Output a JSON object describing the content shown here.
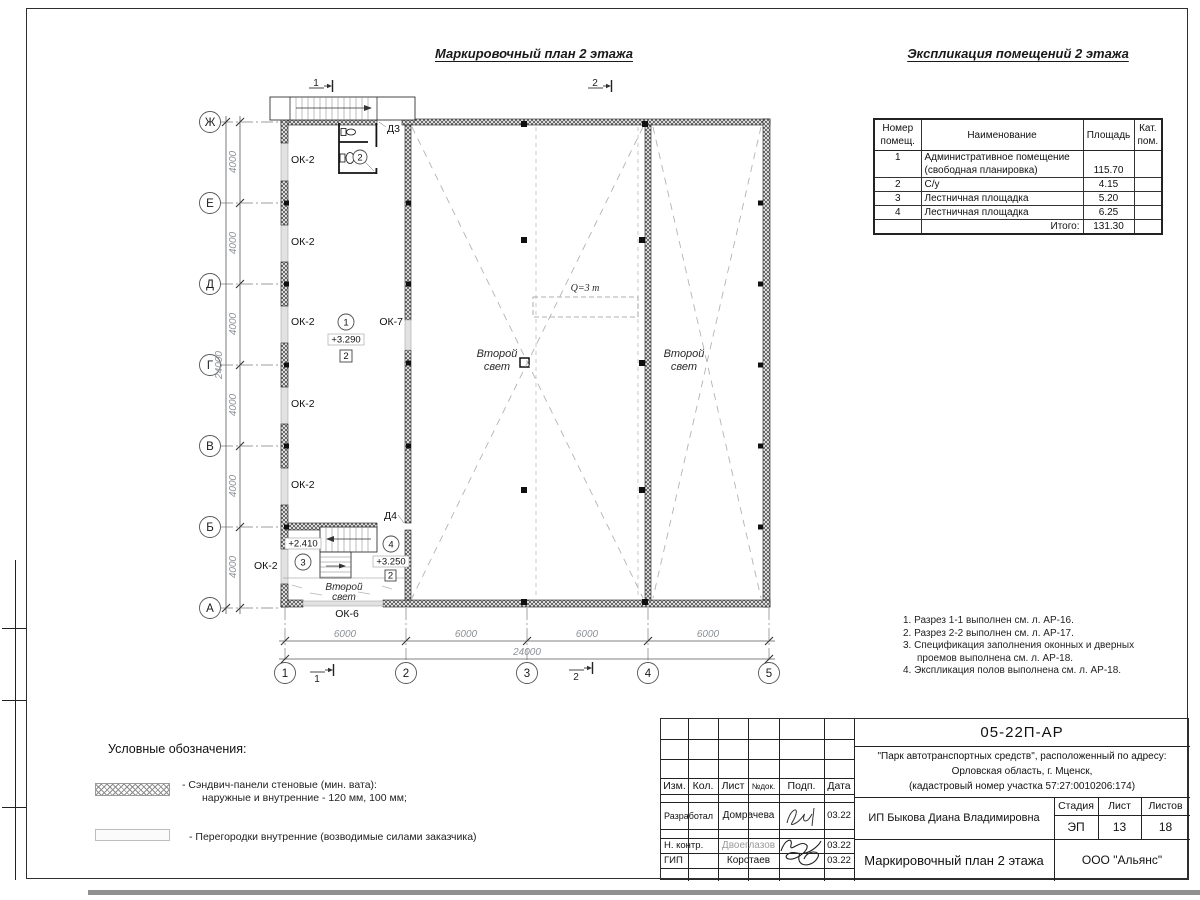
{
  "titles": {
    "plan": "Маркировочный план 2 этажа",
    "table": "Экспликация помещений 2 этажа"
  },
  "axis": {
    "rows": [
      "Ж",
      "Е",
      "Д",
      "Г",
      "В",
      "Б",
      "А"
    ],
    "cols": [
      "1",
      "2",
      "3",
      "4",
      "5"
    ]
  },
  "dims": {
    "bay_v": "4000",
    "bay_h": "6000",
    "total": "24000"
  },
  "marks": {
    "m1": "1",
    "m2": "2"
  },
  "plan": {
    "ok2": "ОК-2",
    "ok6": "ОК-6",
    "ok7": "ОК-7",
    "d3": "Д3",
    "d4": "Д4",
    "room1": "1",
    "room2": "2",
    "room3": "3",
    "room4": "4",
    "elev1": "+3.290",
    "elev3": "+2.410",
    "elev4": "+3.250",
    "floor": "2",
    "crane": "Q=3 т",
    "sl1": "Второй",
    "sl2": "свет"
  },
  "table": {
    "h_num1": "Номер",
    "h_num2": "помещ.",
    "h_name": "Наименование",
    "h_area": "Площадь",
    "h_cat1": "Кат.",
    "h_cat2": "пом.",
    "rows": [
      {
        "num": "1",
        "name": "Административное помещение",
        "area": "",
        "cat": ""
      },
      {
        "num": "",
        "name": "(свободная планировка)",
        "area": "115.70",
        "cat": ""
      },
      {
        "num": "2",
        "name": "С/у",
        "area": "4.15",
        "cat": ""
      },
      {
        "num": "3",
        "name": "Лестничная площадка",
        "area": "5.20",
        "cat": ""
      },
      {
        "num": "4",
        "name": "Лестничная площадка",
        "area": "6.25",
        "cat": ""
      }
    ],
    "total_label": "Итого:",
    "total_value": "131.30"
  },
  "legend": {
    "title": "Условные обозначения:",
    "item1_line1": "- Сэндвич-панели стеновые (мин. вата):",
    "item1_line2": "наружные и внутренние - 120 мм, 100 мм;",
    "item2": "- Перегородки внутренние (возводимые силами заказчика)"
  },
  "notes": {
    "n1": "1. Разрез 1-1 выполнен см. л. АР-16.",
    "n2": "2. Разрез 2-2 выполнен см. л. АР-17.",
    "n3": "3. Спецификация заполнения оконных и дверных проемов выполнена см. л. АР-18.",
    "n4": "4. Экспликация полов выполнена см. л. АР-18."
  },
  "tb": {
    "doc": "05-22П-АР",
    "project1": "\"Парк автотранспортных средств\",  расположенный по адресу:",
    "project2": "Орловская область, г. Мценск,",
    "project3": "(кадастровый номер участка 57:27:0010206:174)",
    "client": "ИП Быкова Диана Владимировна",
    "sheet_name": "Маркировочный план 2 этажа",
    "company": "ООО \"Альянс\"",
    "stage_label": "Стадия",
    "sheet_label": "Лист",
    "sheets_label": "Листов",
    "stage": "ЭП",
    "sheet_no": "13",
    "sheets_total": "18",
    "c_izm": "Изм.",
    "c_kol": "Кол.",
    "c_list": "Лист",
    "c_ndok": "№док.",
    "c_podp": "Подп.",
    "c_data": "Дата",
    "r1_role": "Разработал",
    "r1_name": "Домрачева",
    "r1_date": "03.22",
    "r2_role": "Н. контр.",
    "r2_name": "Двоеглазов",
    "r2_date": "03.22",
    "r3_role": "ГИП",
    "r3_name": "Коротаев",
    "r3_date": "03.22"
  }
}
